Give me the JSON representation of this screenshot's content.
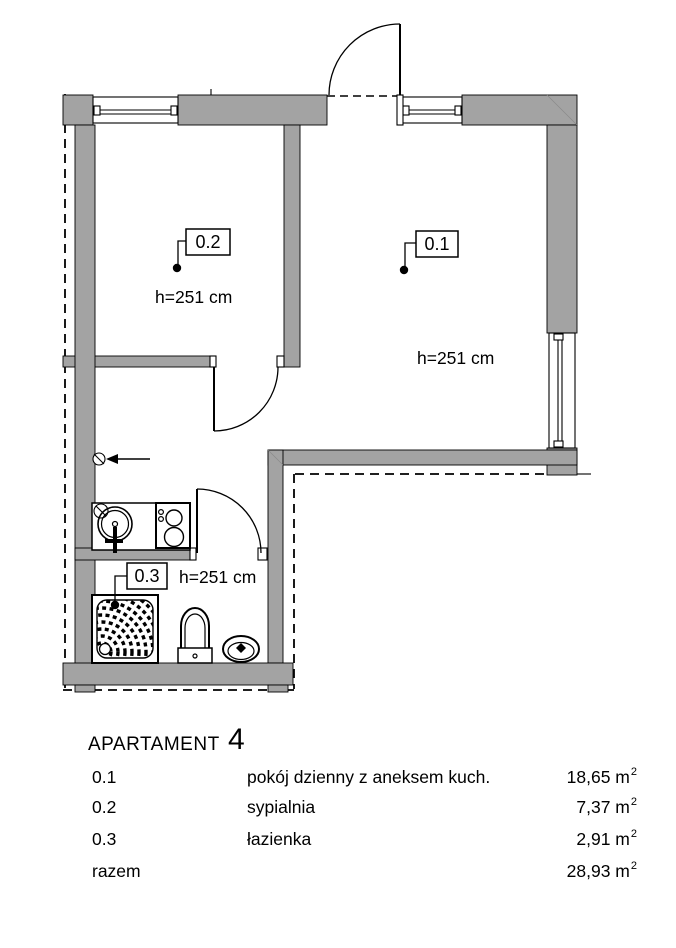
{
  "header": {
    "title": "APARTAMENT",
    "number": "4"
  },
  "plan": {
    "wall_color": "#a3a3a3",
    "room_labels": [
      {
        "id": "0.1",
        "height": "h=251 cm"
      },
      {
        "id": "0.2",
        "height": "h=251 cm"
      },
      {
        "id": "0.3",
        "height": "h=251 cm"
      }
    ]
  },
  "legend": {
    "rows": [
      {
        "id": "0.1",
        "name": "pokój dzienny z aneksem kuch.",
        "area": "18,65 m",
        "sup": "2"
      },
      {
        "id": "0.2",
        "name": "sypialnia",
        "area": "7,37 m",
        "sup": "2"
      },
      {
        "id": "0.3",
        "name": "łazienka",
        "area": "2,91 m",
        "sup": "2"
      },
      {
        "id": "razem",
        "name": "",
        "area": "28,93 m",
        "sup": "2"
      }
    ]
  }
}
